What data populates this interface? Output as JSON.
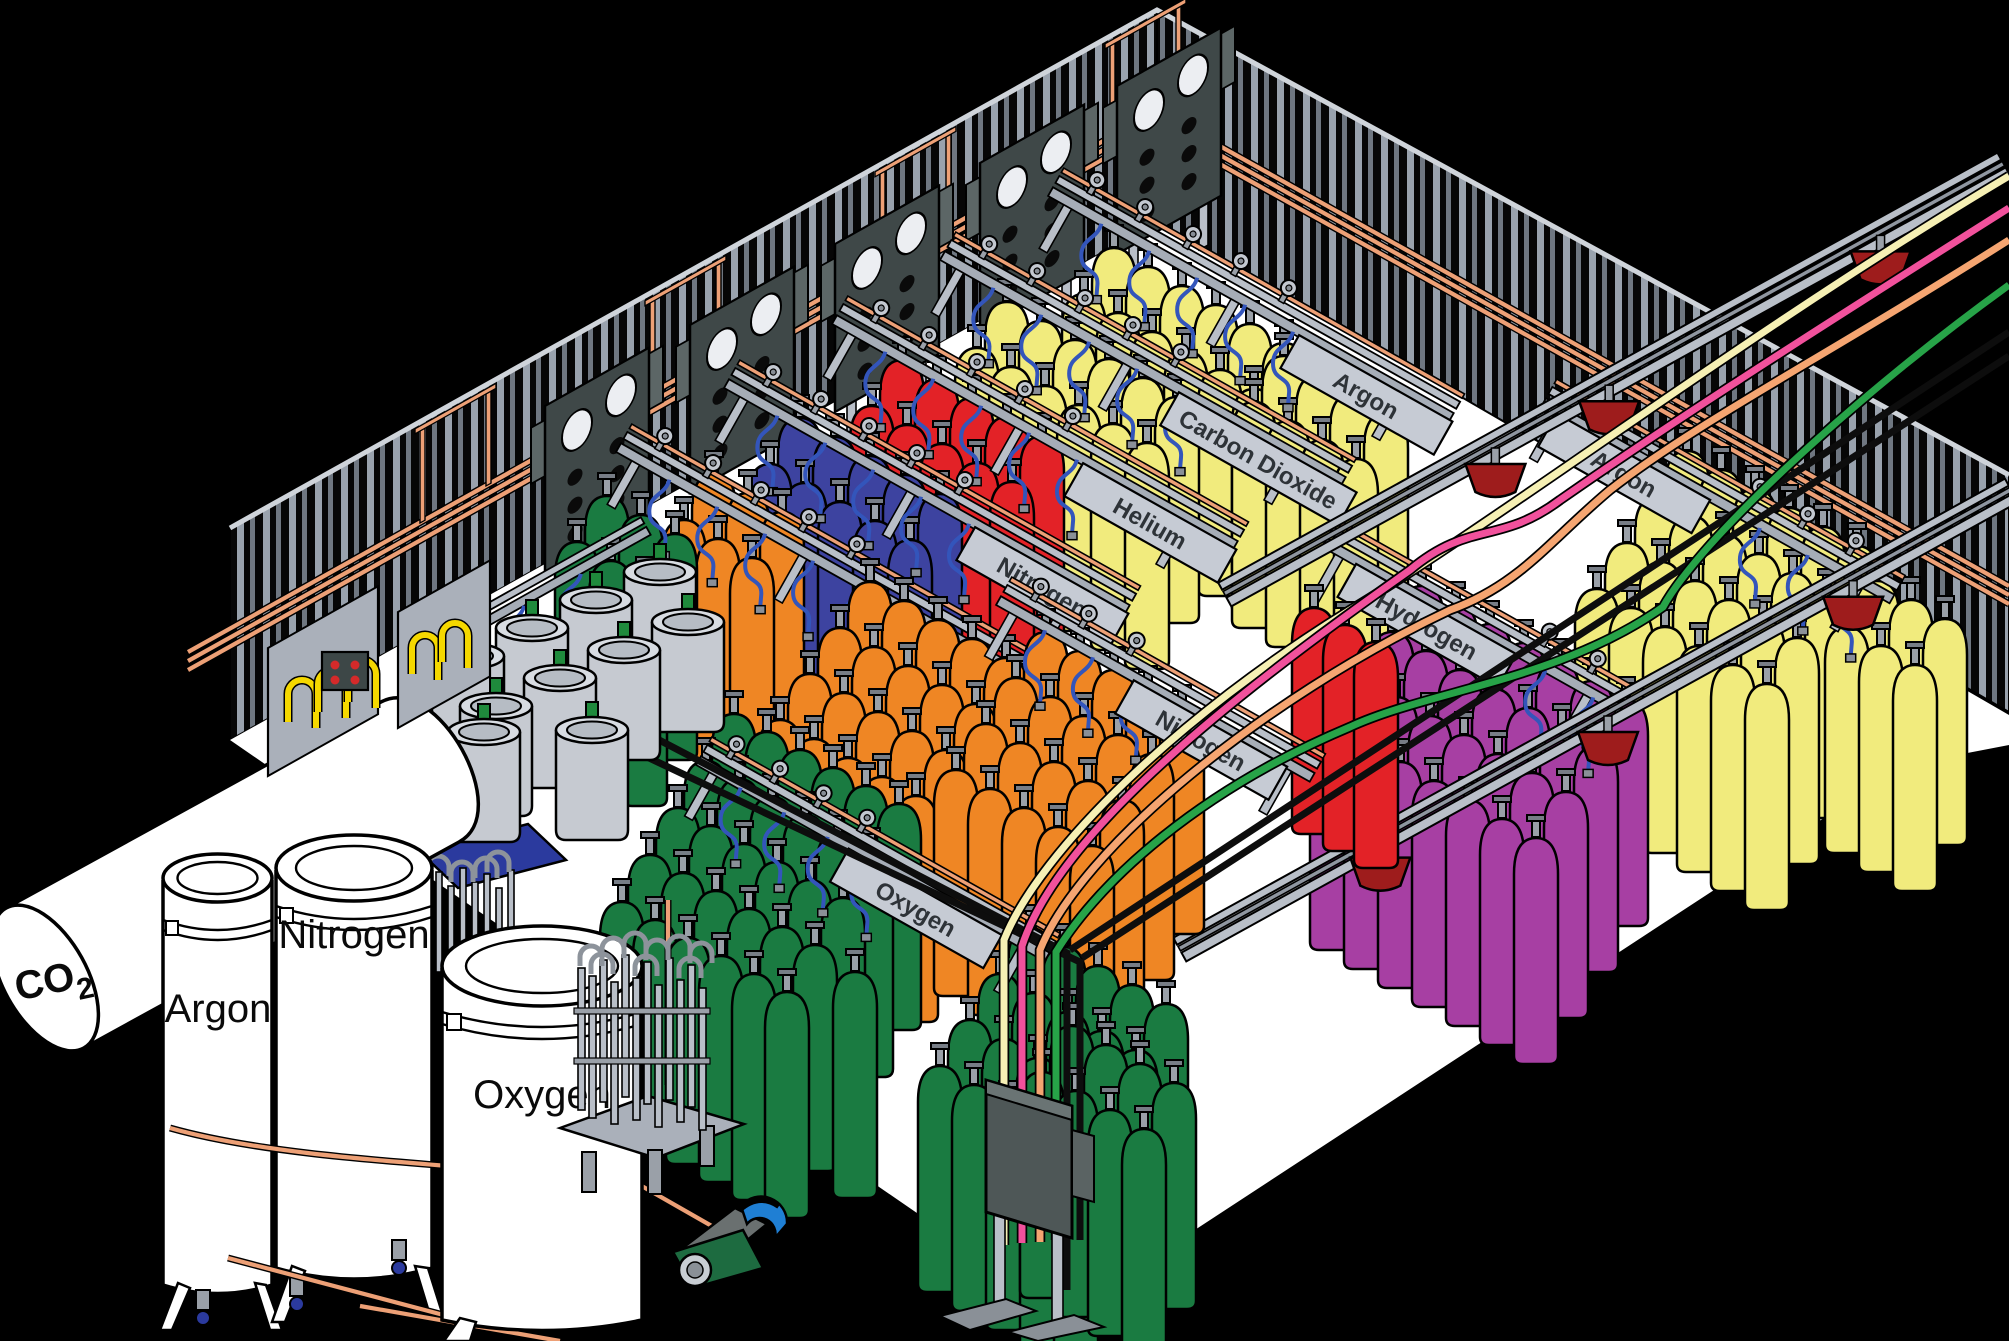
{
  "tank_labels": {
    "co2": "CO",
    "co2_sub": "2",
    "argon": "Argon",
    "nitrogen": "Nitrogen",
    "oxygen": "Oxygen"
  },
  "station_signs": {
    "oxygen_back": "Oxygen",
    "nitrogen_back": "Nitrogen",
    "helium": "Helium",
    "carbon_dioxide": "Carbon Dioxide",
    "argon_upper": "Argon",
    "hydrogen": "Hydrogen",
    "argon_right": "Argon",
    "nitrogen_mid": "Nitrogen",
    "oxygen_front": "Oxygen"
  },
  "colors": {
    "oxygen": "#1a7b41",
    "nitrogen_small": "#3d43a0",
    "nitrogen_large": "#ef8624",
    "helium": "#e32227",
    "carbon_dioxide": "#f1eb7d",
    "argon": "#f1eb7d",
    "hydrogen": "#a73fa3",
    "copper_pipe": "#eda076",
    "hose_blue": "#3355bb",
    "hose_yellow": "#f5d800",
    "trolley_red": "#9e1c1c",
    "supply_cream": "#f6f0b4",
    "supply_pink": "#f1519c",
    "supply_peach": "#f5a571",
    "supply_green": "#27a348"
  },
  "cylinder_groups": [
    {
      "slot": "cyl-argon-upper",
      "color": "argon",
      "blocks": [
        {
          "x": 1092,
          "y": 222,
          "rows": 2,
          "cols": 6
        },
        {
          "x": 1262,
          "y": 330,
          "rows": 2,
          "cols": 4
        }
      ]
    },
    {
      "slot": "cyl-co2",
      "color": "carbon_dioxide",
      "blocks": [
        {
          "x": 985,
          "y": 276,
          "rows": 2,
          "cols": 6
        }
      ]
    },
    {
      "slot": "cyl-helium",
      "color": "helium",
      "blocks": [
        {
          "x": 880,
          "y": 334,
          "rows": 2,
          "cols": 5,
          "cdx": 35
        }
      ]
    },
    {
      "slot": "cyl-nitrogen-small",
      "color": "nitrogen_small",
      "blocks": [
        {
          "x": 778,
          "y": 392,
          "rows": 2,
          "cols": 5,
          "cdx": 35
        }
      ]
    },
    {
      "slot": "cyl-orange-back",
      "color": "nitrogen_large",
      "blocks": [
        {
          "x": 692,
          "y": 448,
          "rows": 2,
          "cols": 3
        }
      ]
    },
    {
      "slot": "cyl-oxygen-back",
      "color": "oxygen",
      "blocks": [
        {
          "x": 585,
          "y": 470,
          "rows": 2,
          "cols": 3
        }
      ]
    },
    {
      "slot": "cyl-argon-right",
      "color": "argon",
      "blocks": [
        {
          "x": 1665,
          "y": 425,
          "rows": 4,
          "cols": 6
        },
        {
          "x": 1855,
          "y": 555,
          "rows": 2,
          "cols": 3
        }
      ]
    },
    {
      "slot": "cyl-hydrogen",
      "color": "hydrogen",
      "blocks": [
        {
          "x": 1400,
          "y": 560,
          "rows": 4,
          "cols": 7
        }
      ]
    },
    {
      "slot": "cyl-helium-mid",
      "color": "helium",
      "blocks": [
        {
          "x": 1292,
          "y": 582,
          "rows": 1,
          "cols": 3,
          "cdx": 31,
          "cdy": 17
        }
      ]
    },
    {
      "slot": "cyl-nitrogen-mid",
      "color": "nitrogen_large",
      "blocks": [
        {
          "x": 848,
          "y": 556,
          "rows": 4,
          "cols": 5
        },
        {
          "x": 1024,
          "y": 606,
          "rows": 4,
          "cols": 5
        }
      ]
    },
    {
      "slot": "cyl-oxygen-mid",
      "color": "oxygen",
      "blocks": [
        {
          "x": 712,
          "y": 688,
          "rows": 5,
          "cols": 6,
          "cdx": 33,
          "cdy": 18,
          "rdx": -28,
          "rdy": 47
        },
        {
          "x": 1008,
          "y": 902,
          "rows": 4,
          "cols": 5
        },
        {
          "x": 1050,
          "y": 1000,
          "rows": 2,
          "cols": 4
        }
      ]
    },
    {
      "slot": "cyl-green-lone",
      "color": "oxygen",
      "blocks": [
        {
          "x": 833,
          "y": 946,
          "rows": 1,
          "cols": 1
        }
      ]
    }
  ]
}
